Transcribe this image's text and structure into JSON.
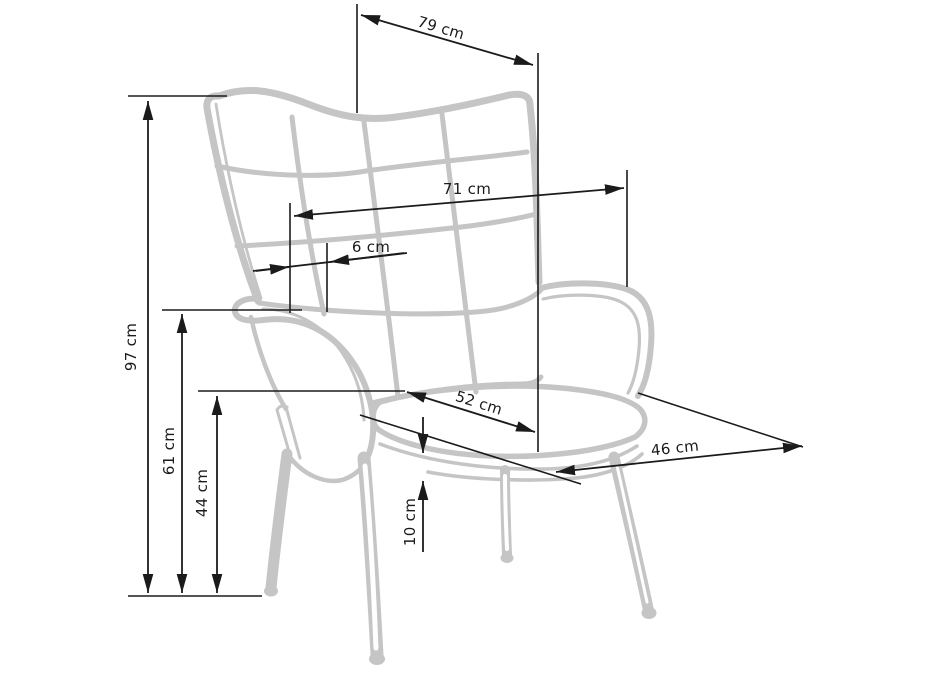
{
  "title": "Armchair dimensions diagram",
  "colors": {
    "background": "#ffffff",
    "chair": "#c5c5c5",
    "dimension": "#1b1b1b",
    "text": "#1b1b1b"
  },
  "measurements": {
    "m79": {
      "label": "79 cm",
      "value": 79,
      "unit": "cm"
    },
    "m71": {
      "label": "71 cm",
      "value": 71,
      "unit": "cm"
    },
    "m6": {
      "label": "6 cm",
      "value": 6,
      "unit": "cm"
    },
    "m97": {
      "label": "97 cm",
      "value": 97,
      "unit": "cm"
    },
    "m61": {
      "label": "61 cm",
      "value": 61,
      "unit": "cm"
    },
    "m44": {
      "label": "44 cm",
      "value": 44,
      "unit": "cm"
    },
    "m52": {
      "label": "52 cm",
      "value": 52,
      "unit": "cm"
    },
    "m10": {
      "label": "10 cm",
      "value": 10,
      "unit": "cm"
    },
    "m46": {
      "label": "46 cm",
      "value": 46,
      "unit": "cm"
    }
  }
}
